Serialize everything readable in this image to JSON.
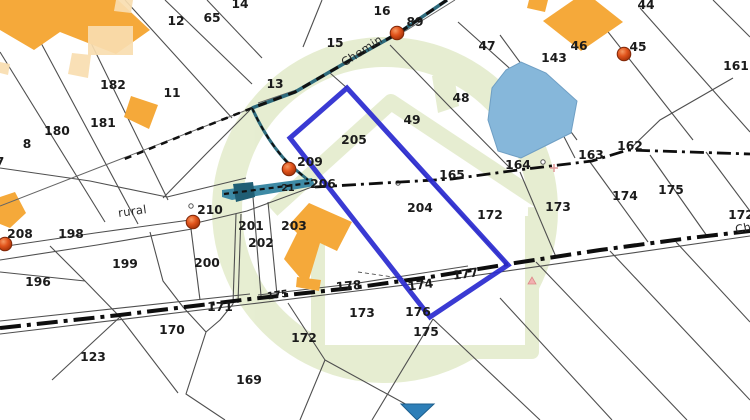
{
  "map": {
    "type": "cadastral-parcel-map",
    "colors": {
      "highlight_parcel": "#2b2bd0",
      "building_solid": "#f5a93a",
      "building_light": "#f8ddb0",
      "water_pond": "#86b7da",
      "water_stream": "#3e8aa5",
      "water_dark": "#205e74",
      "water_triangle": "#2e7fb8",
      "watermark": "#e4eccd",
      "address_dot": "#d54e12",
      "boundary_line": "#4f4f4f",
      "road_dash": "#111111"
    },
    "labels": [
      {
        "text": "14",
        "x": 240,
        "y": 8
      },
      {
        "text": "65",
        "x": 212,
        "y": 22
      },
      {
        "text": "12",
        "x": 176,
        "y": 25
      },
      {
        "text": "16",
        "x": 382,
        "y": 15
      },
      {
        "text": "89",
        "x": 415,
        "y": 26
      },
      {
        "text": "44",
        "x": 646,
        "y": 9
      },
      {
        "text": "15",
        "x": 335,
        "y": 47
      },
      {
        "text": "47",
        "x": 487,
        "y": 50
      },
      {
        "text": "46",
        "x": 579,
        "y": 50
      },
      {
        "text": "45",
        "x": 638,
        "y": 51
      },
      {
        "text": "143",
        "x": 554,
        "y": 62
      },
      {
        "text": "161",
        "x": 736,
        "y": 70
      },
      {
        "text": "13",
        "x": 275,
        "y": 88
      },
      {
        "text": "182",
        "x": 113,
        "y": 89
      },
      {
        "text": "11",
        "x": 172,
        "y": 97
      },
      {
        "text": "48",
        "x": 461,
        "y": 102
      },
      {
        "text": "49",
        "x": 412,
        "y": 124
      },
      {
        "text": "181",
        "x": 103,
        "y": 127
      },
      {
        "text": "180",
        "x": 57,
        "y": 135
      },
      {
        "text": "205",
        "x": 354,
        "y": 144
      },
      {
        "text": "8",
        "x": 27,
        "y": 148
      },
      {
        "text": "7",
        "x": 0,
        "y": 166
      },
      {
        "text": "162",
        "x": 630,
        "y": 150
      },
      {
        "text": "163",
        "x": 591,
        "y": 159
      },
      {
        "text": "209",
        "x": 310,
        "y": 166
      },
      {
        "text": "164",
        "x": 518,
        "y": 169
      },
      {
        "text": "165",
        "x": 452,
        "y": 179
      },
      {
        "text": "206",
        "x": 323,
        "y": 188
      },
      {
        "text": "21",
        "x": 288,
        "y": 191,
        "size": 9.5
      },
      {
        "text": "175",
        "x": 671,
        "y": 194
      },
      {
        "text": "174",
        "x": 625,
        "y": 200
      },
      {
        "text": "173",
        "x": 558,
        "y": 211
      },
      {
        "text": "204",
        "x": 420,
        "y": 212
      },
      {
        "text": "rural",
        "x": 133,
        "y": 215,
        "rot": -8,
        "road": true
      },
      {
        "text": "210",
        "x": 210,
        "y": 214
      },
      {
        "text": "172",
        "x": 490,
        "y": 219
      },
      {
        "text": "172",
        "x": 741,
        "y": 219
      },
      {
        "text": "201",
        "x": 251,
        "y": 230
      },
      {
        "text": "203",
        "x": 294,
        "y": 230
      },
      {
        "text": "Ch",
        "x": 744,
        "y": 232,
        "rot": -12,
        "road": true
      },
      {
        "text": "208",
        "x": 20,
        "y": 238
      },
      {
        "text": "198",
        "x": 71,
        "y": 238
      },
      {
        "text": "202",
        "x": 261,
        "y": 247
      },
      {
        "text": "199",
        "x": 125,
        "y": 268
      },
      {
        "text": "200",
        "x": 207,
        "y": 267
      },
      {
        "text": "177",
        "x": 466,
        "y": 278,
        "rot": -8
      },
      {
        "text": "196",
        "x": 38,
        "y": 286
      },
      {
        "text": "174",
        "x": 421,
        "y": 289,
        "rot": -8
      },
      {
        "text": "178",
        "x": 349,
        "y": 290,
        "rot": -5
      },
      {
        "text": "175",
        "x": 278,
        "y": 298,
        "rot": -8,
        "size": 10
      },
      {
        "text": "171",
        "x": 220,
        "y": 311
      },
      {
        "text": "176",
        "x": 418,
        "y": 316
      },
      {
        "text": "173",
        "x": 362,
        "y": 317
      },
      {
        "text": "170",
        "x": 172,
        "y": 334
      },
      {
        "text": "175",
        "x": 426,
        "y": 336
      },
      {
        "text": "172",
        "x": 304,
        "y": 342
      },
      {
        "text": "123",
        "x": 93,
        "y": 361
      },
      {
        "text": "169",
        "x": 249,
        "y": 384
      },
      {
        "text": "Chemin",
        "x": 364,
        "y": 54,
        "rot": -33,
        "road": true
      }
    ],
    "address_points": [
      {
        "x": 397,
        "y": 33
      },
      {
        "x": 624,
        "y": 54
      },
      {
        "x": 289,
        "y": 169
      },
      {
        "x": 193,
        "y": 222
      },
      {
        "x": 5,
        "y": 244
      }
    ],
    "selected_parcel": {
      "points": "347,88 290,138 430,317 508,265"
    }
  }
}
